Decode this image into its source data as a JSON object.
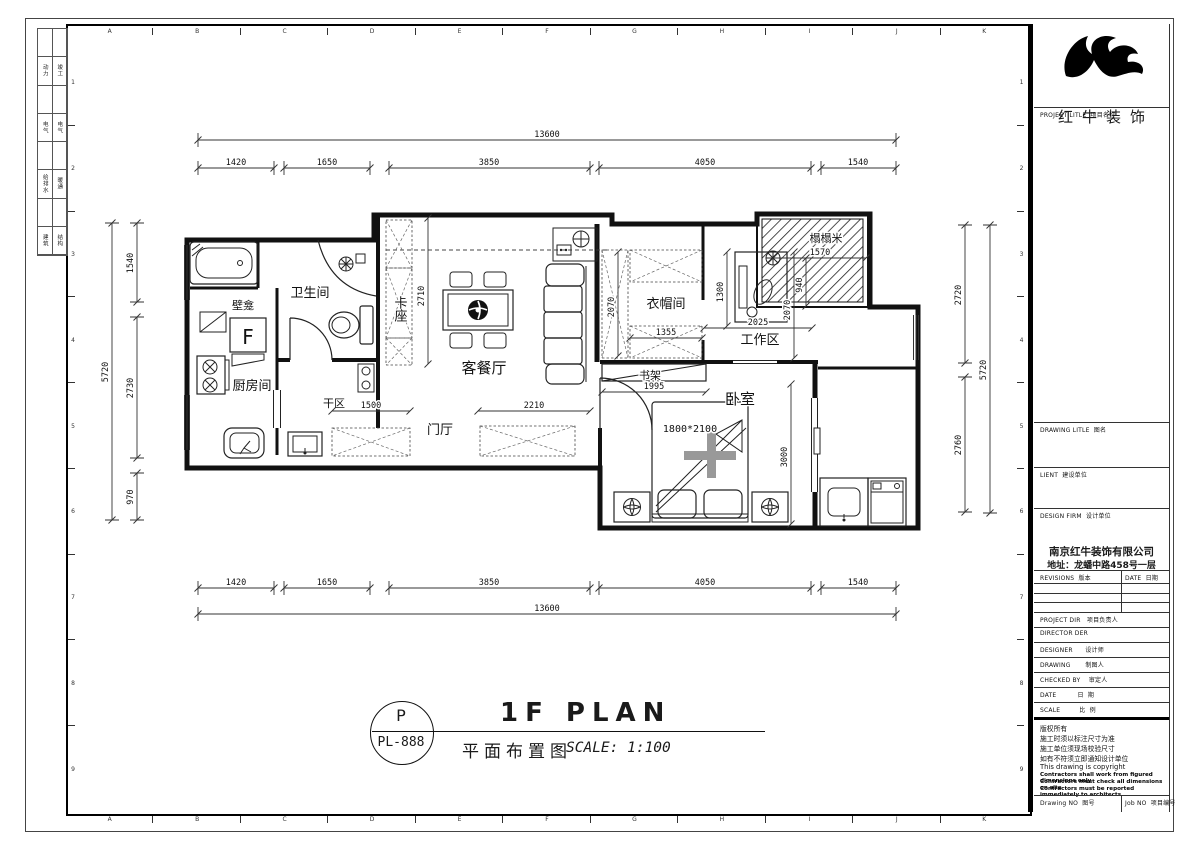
{
  "colors": {
    "ink": "#1a1a1a",
    "paper": "#ffffff"
  },
  "frame": {
    "col_letters": [
      "A",
      "B",
      "C",
      "D",
      "E",
      "F",
      "G",
      "H",
      "I",
      "J",
      "K"
    ],
    "row_numbers": [
      "1",
      "2",
      "3",
      "4",
      "5",
      "6",
      "7",
      "8",
      "9"
    ],
    "discipline_table": [
      [
        "动力",
        "竣工"
      ],
      [
        "电气",
        "电气"
      ],
      [
        "给排水",
        "暖通"
      ],
      [
        "建筑",
        "结构"
      ]
    ]
  },
  "title_block": {
    "brand_name": "红牛装饰",
    "project_title_label": "PROJECT LITLE  项目名称",
    "drawing_title_label": "DRAWING LITLE  图名",
    "client_label": "LIENT  建设单位",
    "design_firm_label": "DESIGN FIRM  设计单位",
    "firm_name": "南京红牛装饰有限公司",
    "firm_address": "地址：龙蟠中路458号一层",
    "revisions_label": "REVISIONS  版本",
    "date_col_label": "DATE  日期",
    "project_dir_label": "PROJECT DIR   项目负责人",
    "director_label": "DIRECTOR DER",
    "designer_label": "DESIGNER      设计师",
    "drawing_label": "DRAWING       制图人",
    "checked_label": "CHECKED BY    审定人",
    "date_row_label": "DATE          日  期",
    "scale_row_label": "SCALE         比  例",
    "notes": [
      "版权所有",
      "施工时须以标注尺寸为准",
      "施工单位须现场校验尺寸",
      "如有不符须立即通知设计单位",
      "This drawing is copyright"
    ],
    "notes_bold": [
      "Contractors shall work from figured dimensions only",
      "Contractors must check all dimensions on site",
      "Contractors must be reported immediately to architects"
    ],
    "drawing_no_label": "Drawing NO  图号",
    "job_no_label": "Job NO  项目编号"
  },
  "drawing_title": {
    "tag_letter": "P",
    "tag_code": "PL-888",
    "title": "1F PLAN",
    "subtitle_cn": "平面布置图",
    "scale_text": "SCALE: 1:100"
  },
  "plan": {
    "rooms": {
      "bathroom": "卫生间",
      "niche": "壁龛",
      "kitchen": "厨房间",
      "booth": "卡座",
      "living_dining": "客餐厅",
      "hall": "门厅",
      "dry_area": "干区",
      "cloakroom": "衣帽间",
      "work_area": "工作区",
      "tatami": "榻榻米",
      "bookshelf": "书架",
      "bedroom": "卧室"
    },
    "furniture": {
      "fridge_label": "F",
      "bed_size": "1800*2100"
    },
    "dims": {
      "top_total": "13600",
      "bottom_total": "13600",
      "top_segments": [
        "1420",
        "1650",
        "3850",
        "4050",
        "1540"
      ],
      "bottom_segments": [
        "1420",
        "1650",
        "3850",
        "4050",
        "1540"
      ],
      "left_total": "5720",
      "left_segments": [
        "1540",
        "2730",
        "970"
      ],
      "right_total": "5720",
      "right_segments": [
        "2720",
        "2760"
      ],
      "booth_height": "2710",
      "cloakroom_width": "1355",
      "cloakroom_height": "2070",
      "work_width": "2025",
      "work_height": "1300",
      "tatami_width": "1570",
      "tatami_height": "940",
      "right_inner_height": "2070",
      "bookshelf_width": "1995",
      "hall_width": "2210",
      "dry_width": "1500",
      "bedroom_height": "3000"
    }
  }
}
